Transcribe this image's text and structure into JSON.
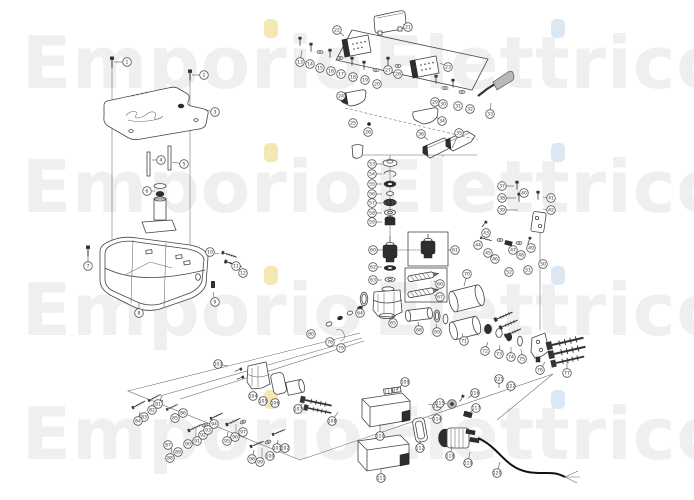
{
  "page": {
    "kind": "exploded-parts-diagram",
    "background": "#ffffff"
  },
  "watermark": {
    "word1": "Emporio",
    "word2": "Elettrico",
    "text_color": "#efefef",
    "i_dot_color_word1": "#f3e8b4",
    "i_dot_color_word2": "#dbe8f4",
    "font_size": 72,
    "word1_x": 22,
    "word2_x": 374,
    "i_dot1_x": 264,
    "i_dot2_x": 551,
    "rows": [
      {
        "baseline": 88
      },
      {
        "baseline": 212
      },
      {
        "baseline": 335
      },
      {
        "baseline": 459
      }
    ]
  },
  "diagram": {
    "line_color": "#444444",
    "callout_stroke": "#555555",
    "callouts": [
      [
        1,
        127,
        62,
        114,
        62
      ],
      [
        2,
        204,
        75,
        192,
        75
      ],
      [
        3,
        215,
        112,
        205,
        110
      ],
      [
        4,
        161,
        160,
        152,
        160
      ],
      [
        5,
        184,
        164,
        172,
        162
      ],
      [
        6,
        147,
        191,
        155,
        191
      ],
      [
        7,
        88,
        266,
        88,
        256
      ],
      [
        8,
        139,
        313,
        139,
        302
      ],
      [
        9,
        215,
        302,
        213,
        292
      ],
      [
        10,
        210,
        252,
        219,
        254
      ],
      [
        11,
        236,
        266
      ],
      [
        12,
        243,
        273
      ],
      [
        13,
        300,
        62,
        302,
        50
      ],
      [
        14,
        310,
        64
      ],
      [
        15,
        320,
        68
      ],
      [
        16,
        331,
        71
      ],
      [
        17,
        341,
        74
      ],
      [
        18,
        353,
        77
      ],
      [
        19,
        365,
        80
      ],
      [
        20,
        377,
        84
      ],
      [
        21,
        408,
        27,
        403,
        24
      ],
      [
        22,
        337,
        30,
        344,
        36
      ],
      [
        23,
        448,
        67,
        440,
        63
      ],
      [
        24,
        341,
        96,
        346,
        97
      ],
      [
        25,
        353,
        123
      ],
      [
        26,
        368,
        132
      ],
      [
        27,
        388,
        70
      ],
      [
        28,
        398,
        74
      ],
      [
        29,
        435,
        102
      ],
      [
        30,
        443,
        104
      ],
      [
        31,
        458,
        106
      ],
      [
        32,
        470,
        109
      ],
      [
        33,
        490,
        114,
        491,
        103
      ],
      [
        34,
        442,
        121,
        436,
        117
      ],
      [
        35,
        459,
        133,
        452,
        148
      ],
      [
        36,
        421,
        134,
        428,
        140
      ],
      [
        37,
        502,
        186,
        514,
        186
      ],
      [
        38,
        502,
        198,
        516,
        198
      ],
      [
        39,
        502,
        210,
        518,
        210
      ],
      [
        40,
        524,
        193
      ],
      [
        41,
        551,
        198,
        543,
        197
      ],
      [
        42,
        551,
        210,
        543,
        209
      ],
      [
        43,
        486,
        233
      ],
      [
        44,
        478,
        245
      ],
      [
        45,
        488,
        253
      ],
      [
        46,
        495,
        259
      ],
      [
        47,
        513,
        250
      ],
      [
        48,
        521,
        255
      ],
      [
        49,
        531,
        248
      ],
      [
        50,
        543,
        264
      ],
      [
        51,
        528,
        270
      ],
      [
        52,
        509,
        272
      ],
      [
        53,
        372,
        164,
        382,
        164
      ],
      [
        54,
        372,
        174,
        382,
        174
      ],
      [
        55,
        372,
        184,
        382,
        184
      ],
      [
        56,
        372,
        194,
        382,
        194
      ],
      [
        57,
        372,
        203,
        382,
        203
      ],
      [
        58,
        372,
        213,
        382,
        213
      ],
      [
        59,
        372,
        222,
        382,
        222
      ],
      [
        60,
        373,
        250,
        383,
        250
      ],
      [
        61,
        455,
        250,
        448,
        250
      ],
      [
        62,
        373,
        267,
        382,
        267
      ],
      [
        63,
        373,
        280,
        382,
        280
      ],
      [
        64,
        360,
        313,
        363,
        306
      ],
      [
        65,
        393,
        323,
        392,
        314
      ],
      [
        66,
        440,
        284,
        434,
        281
      ],
      [
        67,
        440,
        297,
        434,
        295
      ],
      [
        68,
        419,
        330,
        418,
        322
      ],
      [
        69,
        437,
        332,
        436,
        324
      ],
      [
        70,
        467,
        274,
        464,
        286
      ],
      [
        71,
        464,
        341,
        462,
        333
      ],
      [
        72,
        485,
        351,
        488,
        342
      ],
      [
        73,
        499,
        354,
        500,
        345
      ],
      [
        74,
        511,
        357,
        511,
        347
      ],
      [
        75,
        522,
        359,
        521,
        349
      ],
      [
        76,
        540,
        370,
        545,
        362
      ],
      [
        77,
        567,
        373,
        567,
        360
      ],
      [
        78,
        330,
        342
      ],
      [
        79,
        341,
        348
      ],
      [
        80,
        311,
        334
      ],
      [
        81,
        158,
        404,
        162,
        396
      ],
      [
        82,
        152,
        410
      ],
      [
        83,
        144,
        417
      ],
      [
        84,
        138,
        421,
        140,
        412
      ],
      [
        85,
        175,
        418
      ],
      [
        86,
        183,
        413
      ],
      [
        87,
        168,
        445
      ],
      [
        88,
        170,
        458,
        172,
        448
      ],
      [
        89,
        178,
        452
      ],
      [
        90,
        188,
        444
      ],
      [
        91,
        197,
        441
      ],
      [
        92,
        203,
        435
      ],
      [
        93,
        208,
        430
      ],
      [
        94,
        214,
        424
      ],
      [
        95,
        227,
        441,
        228,
        432
      ],
      [
        96,
        235,
        437
      ],
      [
        97,
        243,
        432
      ],
      [
        98,
        252,
        459,
        254,
        450
      ],
      [
        99,
        260,
        462
      ],
      [
        100,
        270,
        456
      ],
      [
        101,
        277,
        448,
        278,
        440
      ],
      [
        102,
        285,
        448
      ],
      [
        103,
        218,
        364,
        228,
        366
      ],
      [
        104,
        253,
        396
      ],
      [
        105,
        263,
        401
      ],
      [
        106,
        275,
        403
      ],
      [
        107,
        298,
        409,
        305,
        400
      ],
      [
        108,
        332,
        421,
        338,
        412
      ],
      [
        109,
        405,
        382,
        396,
        390
      ],
      [
        110,
        380,
        436,
        380,
        424
      ],
      [
        111,
        381,
        478,
        381,
        468
      ],
      [
        112,
        420,
        448,
        420,
        440
      ],
      [
        113,
        437,
        406,
        428,
        404
      ],
      [
        114,
        437,
        419,
        428,
        418
      ],
      [
        115,
        440,
        403,
        447,
        404
      ],
      [
        116,
        475,
        393,
        468,
        398
      ],
      [
        117,
        476,
        408,
        470,
        412
      ],
      [
        118,
        450,
        456,
        452,
        446
      ],
      [
        119,
        468,
        463,
        470,
        452
      ],
      [
        120,
        497,
        473,
        500,
        462
      ],
      [
        121,
        499,
        379,
        499,
        388
      ],
      [
        122,
        511,
        386,
        510,
        392
      ]
    ]
  }
}
